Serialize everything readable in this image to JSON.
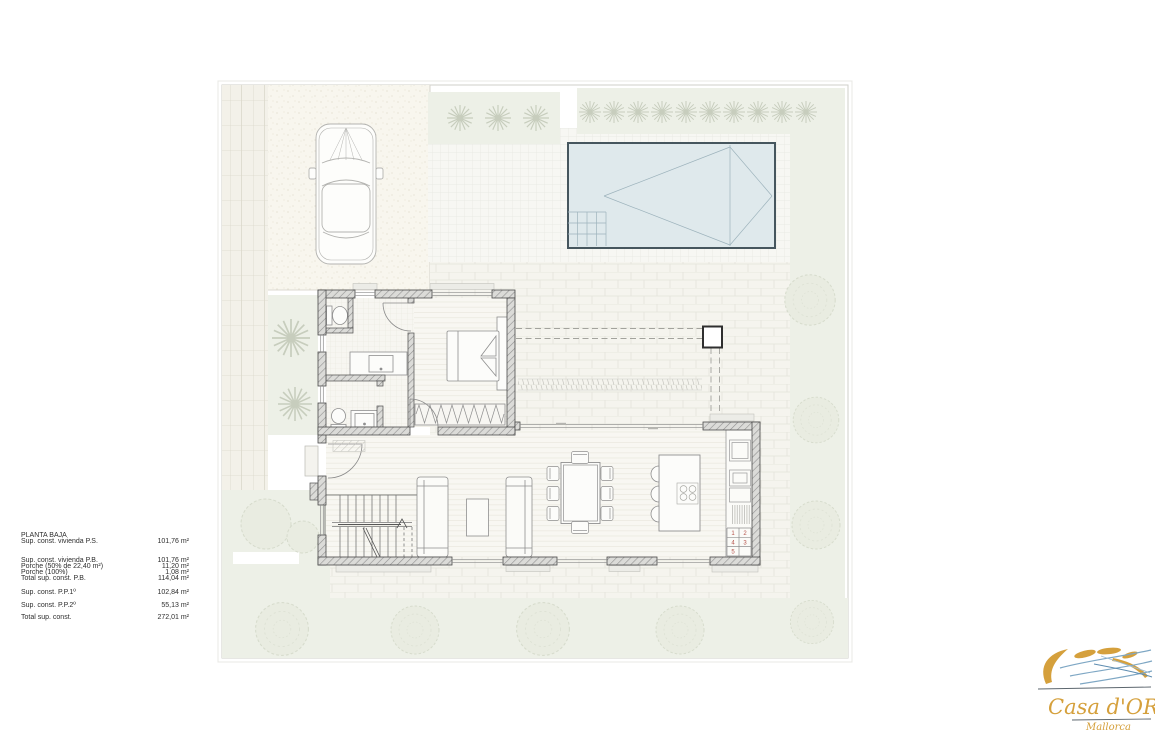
{
  "areas": {
    "title": "PLANTA BAJA",
    "rows": [
      {
        "label": "Sup. const. vivienda P.S.",
        "value": "101,76 m²"
      },
      {
        "label": "Sup. const. vivienda P.B.",
        "value": "101,76 m²"
      },
      {
        "label": "Porche  (50% de 22,40 m²)",
        "value": "11,20 m²"
      },
      {
        "label": "Porche  (100%)",
        "value": "1,08 m²"
      },
      {
        "label": "Total sup. const. P.B.",
        "value": "114,04 m²"
      },
      {
        "label": "Sup. const. P.P.1º",
        "value": "102,84 m²"
      },
      {
        "label": "Sup. const. P.P.2º",
        "value": "55,13 m²"
      },
      {
        "label": "Total sup. const.",
        "value": "272,01 m²"
      }
    ]
  },
  "kitchen_steps": {
    "numbers": [
      "1",
      "2",
      "4",
      "3",
      "5"
    ]
  },
  "logo": {
    "name": "Casa d'OR",
    "subtitle": "Mallorca"
  },
  "colors": {
    "logo_gold": "#d5a03c",
    "logo_blue": "#7ea7c4",
    "pool_water": "#dfe9ec",
    "step_number_red": "#b5524a",
    "wall_hatch": "#909090"
  }
}
